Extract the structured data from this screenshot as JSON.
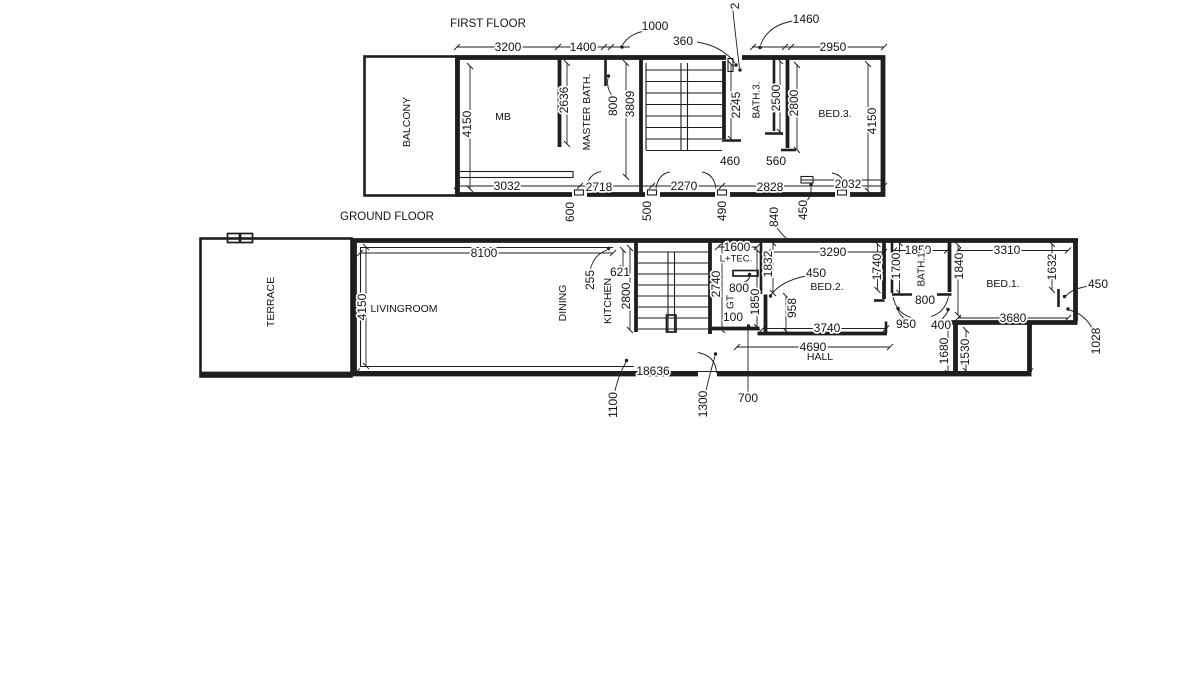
{
  "drawing": {
    "background": "#ffffff",
    "line_color": "#1e1e1e",
    "text_color": "#141414"
  },
  "first_floor": {
    "title": "FIRST FLOOR",
    "labels": [
      {
        "n": "first-floor-title",
        "t": "FIRST FLOOR",
        "x": 488,
        "y": 24,
        "r": 0,
        "s": 11.5
      },
      {
        "n": "dim-3200",
        "t": "3200",
        "x": 508,
        "y": 47,
        "r": 0
      },
      {
        "n": "dim-1400",
        "t": "1400",
        "x": 583,
        "y": 47,
        "r": 0
      },
      {
        "n": "dim-1000",
        "t": "1000",
        "x": 655,
        "y": 26,
        "r": 0
      },
      {
        "n": "dim-360",
        "t": "360",
        "x": 683,
        "y": 41,
        "r": 0
      },
      {
        "n": "dim-2-partial",
        "t": "2",
        "x": 735,
        "y": 6,
        "r": 1
      },
      {
        "n": "dim-1460",
        "t": "1460",
        "x": 806,
        "y": 19,
        "r": 0
      },
      {
        "n": "dim-2950",
        "t": "2950",
        "x": 833,
        "y": 47,
        "r": 0
      },
      {
        "n": "room-balcony",
        "t": "BALCONY",
        "x": 407,
        "y": 122,
        "r": 1,
        "s": 10.5
      },
      {
        "n": "dim-4150-left",
        "t": "4150",
        "x": 467,
        "y": 124,
        "r": 1
      },
      {
        "n": "room-mb",
        "t": "MB",
        "x": 503,
        "y": 117,
        "r": 0,
        "s": 10.5
      },
      {
        "n": "dim-2636",
        "t": "2636",
        "x": 564,
        "y": 100,
        "r": 1
      },
      {
        "n": "room-master-bath",
        "t": "MASTER BATH.",
        "x": 587,
        "y": 112,
        "r": 1,
        "s": 10.5
      },
      {
        "n": "dim-800-ff",
        "t": "800",
        "x": 613,
        "y": 106,
        "r": 1
      },
      {
        "n": "dim-3809",
        "t": "3809",
        "x": 630,
        "y": 104,
        "r": 1
      },
      {
        "n": "dim-2245",
        "t": "2245",
        "x": 736,
        "y": 105,
        "r": 1
      },
      {
        "n": "room-bath3",
        "t": "BATH.3.",
        "x": 757,
        "y": 100,
        "r": 1,
        "s": 10
      },
      {
        "n": "dim-2500",
        "t": "2500",
        "x": 776,
        "y": 98,
        "r": 1
      },
      {
        "n": "dim-2800-ff",
        "t": "2800",
        "x": 794,
        "y": 103,
        "r": 1
      },
      {
        "n": "room-bed3",
        "t": "BED.3.",
        "x": 835,
        "y": 114,
        "r": 0,
        "s": 10.5
      },
      {
        "n": "dim-4150-right",
        "t": "4150",
        "x": 872,
        "y": 121,
        "r": 1
      },
      {
        "n": "dim-460",
        "t": "460",
        "x": 730,
        "y": 161,
        "r": 0
      },
      {
        "n": "dim-560",
        "t": "560",
        "x": 776,
        "y": 161,
        "r": 0
      },
      {
        "n": "dim-3032",
        "t": "3032",
        "x": 507,
        "y": 186,
        "r": 0
      },
      {
        "n": "dim-2718",
        "t": "2718",
        "x": 599,
        "y": 187,
        "r": 0
      },
      {
        "n": "dim-2270",
        "t": "2270",
        "x": 684,
        "y": 186,
        "r": 0
      },
      {
        "n": "dim-2828",
        "t": "2828",
        "x": 770,
        "y": 187,
        "r": 0
      },
      {
        "n": "dim-2032",
        "t": "2032",
        "x": 848,
        "y": 184,
        "r": 0
      },
      {
        "n": "dim-600",
        "t": "600",
        "x": 570,
        "y": 212,
        "r": 1
      },
      {
        "n": "dim-500",
        "t": "500",
        "x": 647,
        "y": 211,
        "r": 1
      },
      {
        "n": "dim-490",
        "t": "490",
        "x": 722,
        "y": 211,
        "r": 1
      },
      {
        "n": "dim-840",
        "t": "840",
        "x": 774,
        "y": 217,
        "r": 1
      },
      {
        "n": "dim-450-ff",
        "t": "450",
        "x": 803,
        "y": 210,
        "r": 1
      }
    ]
  },
  "ground_floor": {
    "title": "GROUND FLOOR",
    "labels": [
      {
        "n": "ground-floor-title",
        "t": "GROUND FLOOR",
        "x": 387,
        "y": 217,
        "r": 0,
        "s": 11.5
      },
      {
        "n": "room-terrace",
        "t": "TERRACE",
        "x": 271,
        "y": 302,
        "r": 1,
        "s": 10.5
      },
      {
        "n": "dim-4150-gf",
        "t": "4150",
        "x": 362,
        "y": 307,
        "r": 1
      },
      {
        "n": "room-livingroom",
        "t": "LIVINGROOM",
        "x": 404,
        "y": 309,
        "r": 0,
        "s": 10.5
      },
      {
        "n": "dim-8100",
        "t": "8100",
        "x": 484,
        "y": 253,
        "r": 0
      },
      {
        "n": "room-dining",
        "t": "DINING",
        "x": 563,
        "y": 303,
        "r": 1,
        "s": 10.5
      },
      {
        "n": "dim-255",
        "t": "255",
        "x": 590,
        "y": 280,
        "r": 1
      },
      {
        "n": "dim-621",
        "t": "621",
        "x": 620,
        "y": 272,
        "r": 0
      },
      {
        "n": "room-kitchen",
        "t": "KITCHEN",
        "x": 608,
        "y": 301,
        "r": 1,
        "s": 10.5
      },
      {
        "n": "dim-2800-gf",
        "t": "2800",
        "x": 626,
        "y": 296,
        "r": 1
      },
      {
        "n": "dim-2740",
        "t": "2740",
        "x": 716,
        "y": 284,
        "r": 1
      },
      {
        "n": "dim-1600",
        "t": "1600",
        "x": 737,
        "y": 247,
        "r": 0
      },
      {
        "n": "room-ltec",
        "t": "L+TEC.",
        "x": 736,
        "y": 259,
        "r": 0,
        "s": 9.5
      },
      {
        "n": "dim-1832",
        "t": "1832",
        "x": 768,
        "y": 264,
        "r": 1
      },
      {
        "n": "dim-800-gt",
        "t": "800",
        "x": 739,
        "y": 288,
        "r": 0
      },
      {
        "n": "room-gt",
        "t": "GT",
        "x": 731,
        "y": 302,
        "r": 1,
        "s": 10
      },
      {
        "n": "dim-1850-gt",
        "t": "1850",
        "x": 755,
        "y": 302,
        "r": 1
      },
      {
        "n": "dim-100",
        "t": "100",
        "x": 733,
        "y": 317,
        "r": 0
      },
      {
        "n": "dim-450-bed2",
        "t": "450",
        "x": 816,
        "y": 273,
        "r": 0
      },
      {
        "n": "room-bed2",
        "t": "BED.2.",
        "x": 827,
        "y": 287,
        "r": 0,
        "s": 10.5
      },
      {
        "n": "dim-3290",
        "t": "3290",
        "x": 833,
        "y": 252,
        "r": 0
      },
      {
        "n": "dim-958",
        "t": "958",
        "x": 792,
        "y": 308,
        "r": 1
      },
      {
        "n": "dim-1740",
        "t": "1740",
        "x": 877,
        "y": 267,
        "r": 1
      },
      {
        "n": "dim-1700",
        "t": "1700",
        "x": 896,
        "y": 266,
        "r": 1
      },
      {
        "n": "dim-1850-bath1",
        "t": "1850",
        "x": 918,
        "y": 250,
        "r": 0
      },
      {
        "n": "room-bath1",
        "t": "BATH.1.",
        "x": 922,
        "y": 268,
        "r": 1,
        "s": 10
      },
      {
        "n": "dim-800-bath1",
        "t": "800",
        "x": 925,
        "y": 300,
        "r": 0
      },
      {
        "n": "dim-950",
        "t": "950",
        "x": 906,
        "y": 324,
        "r": 0
      },
      {
        "n": "dim-400",
        "t": "400",
        "x": 941,
        "y": 325,
        "r": 0
      },
      {
        "n": "dim-1840",
        "t": "1840",
        "x": 959,
        "y": 266,
        "r": 1
      },
      {
        "n": "dim-3310",
        "t": "3310",
        "x": 1007,
        "y": 250,
        "r": 0
      },
      {
        "n": "dim-1632",
        "t": "1632",
        "x": 1052,
        "y": 267,
        "r": 1
      },
      {
        "n": "room-bed1",
        "t": "BED.1.",
        "x": 1003,
        "y": 284,
        "r": 0,
        "s": 10.5
      },
      {
        "n": "dim-450-bed1",
        "t": "450",
        "x": 1098,
        "y": 284,
        "r": 0
      },
      {
        "n": "dim-3680",
        "t": "3680",
        "x": 1013,
        "y": 318,
        "r": 0
      },
      {
        "n": "dim-1028",
        "t": "1028",
        "x": 1096,
        "y": 341,
        "r": 1
      },
      {
        "n": "dim-3740",
        "t": "3740",
        "x": 827,
        "y": 328,
        "r": 0
      },
      {
        "n": "dim-4690",
        "t": "4690",
        "x": 813,
        "y": 347,
        "r": 0
      },
      {
        "n": "room-hall",
        "t": "HALL",
        "x": 820,
        "y": 357,
        "r": 0,
        "s": 10.5
      },
      {
        "n": "dim-1680",
        "t": "1680",
        "x": 944,
        "y": 351,
        "r": 1
      },
      {
        "n": "dim-1530",
        "t": "1530",
        "x": 965,
        "y": 352,
        "r": 1
      },
      {
        "n": "dim-18636",
        "t": "18636",
        "x": 653,
        "y": 371,
        "r": 0
      },
      {
        "n": "dim-1100",
        "t": "1100",
        "x": 613,
        "y": 405,
        "r": 1
      },
      {
        "n": "dim-1300",
        "t": "1300",
        "x": 703,
        "y": 404,
        "r": 1
      },
      {
        "n": "dim-700",
        "t": "700",
        "x": 748,
        "y": 398,
        "r": 0
      }
    ]
  }
}
